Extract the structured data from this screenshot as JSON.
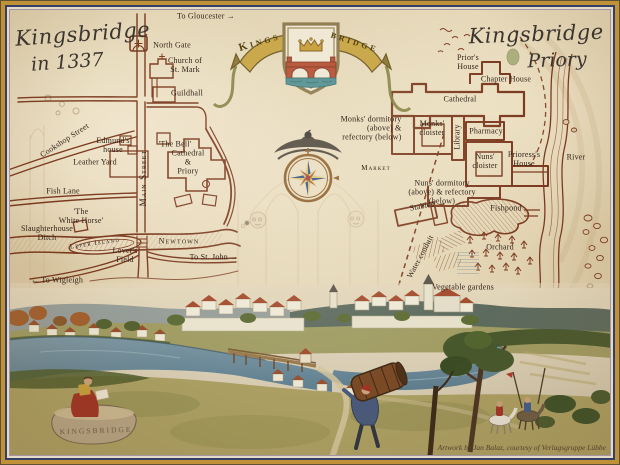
{
  "titles": {
    "town": {
      "line1": "Kingsbridge",
      "line2": "in 1337"
    },
    "priory": {
      "line1": "Kingsbridge",
      "line2": "Priory"
    }
  },
  "banner": {
    "left": "Kings",
    "right": "bridge"
  },
  "monument": {
    "engraving": "KINGSBRIDGE"
  },
  "credit": "Artwork by Jan Balaz, courtesy of Verlagsgruppe Lübbe",
  "colors": {
    "parchment": "#e3d5b5",
    "map_ink": "#7b3a1f",
    "label_ink": "#33241a",
    "frame_gold": "#c09136",
    "frame_navy": "#333f66",
    "banner_gold": "#c6a23f",
    "river_blue": "#6a8697",
    "shield_red": "#b14a2c",
    "compass_navy": "#2e4a7c"
  },
  "decorations": [
    "coat-of-arms",
    "banner-ribbon",
    "compass-rose",
    "falcon-emblem",
    "wind-face",
    "architectural-sketch",
    "reader-figure",
    "barrel-carrier",
    "riders"
  ],
  "town_labels": [
    {
      "id": "to-gloucester",
      "text": "To Gloucester →",
      "x": 206,
      "y": 17
    },
    {
      "id": "north-gate",
      "text": "North Gate",
      "x": 172,
      "y": 46
    },
    {
      "id": "church-of-st-mark",
      "text": "Church of\nSt. Mark",
      "x": 185,
      "y": 66
    },
    {
      "id": "guildhall",
      "text": "Guildhall",
      "x": 187,
      "y": 94
    },
    {
      "id": "cookshop-street",
      "text": "Cookshop Street",
      "x": 65,
      "y": 141,
      "rot": -33
    },
    {
      "id": "edmunds-house",
      "text": "Edmund's\nhouse",
      "x": 113,
      "y": 146
    },
    {
      "id": "the-bell",
      "text": "'The Bell'",
      "x": 175,
      "y": 145
    },
    {
      "id": "leather-yard",
      "text": "Leather Yard",
      "x": 95,
      "y": 163
    },
    {
      "id": "main-street",
      "text": "Main Street",
      "x": 143,
      "y": 178,
      "rot": -90,
      "cls": "caps",
      "size": 9
    },
    {
      "id": "cathedral-and-priory",
      "text": "Cathedral\n&\nPriory",
      "x": 188,
      "y": 163
    },
    {
      "id": "fish-lane",
      "text": "Fish Lane",
      "x": 63,
      "y": 192
    },
    {
      "id": "the-white-horse",
      "text": "'The\nWhite Horse'",
      "x": 81,
      "y": 217
    },
    {
      "id": "slaughterhouse-ditch",
      "text": "Slaughterhouse\nDitch",
      "x": 47,
      "y": 234
    },
    {
      "id": "leper-island",
      "text": "Leper Island",
      "x": 95,
      "y": 244,
      "rot": -8,
      "cls": "caps",
      "size": 7
    },
    {
      "id": "lovers-field",
      "text": "Lover's\nField",
      "x": 125,
      "y": 256
    },
    {
      "id": "newtown",
      "text": "Newtown",
      "x": 179,
      "y": 242,
      "cls": "caps"
    },
    {
      "id": "to-st-john",
      "text": "To St. John →",
      "x": 214,
      "y": 258
    },
    {
      "id": "to-wigleigh",
      "text": "← To Wigleigh",
      "x": 57,
      "y": 281
    }
  ],
  "priory_labels": [
    {
      "id": "priors-house",
      "text": "Prior's\nHouse",
      "x": 468,
      "y": 63
    },
    {
      "id": "chapter-house",
      "text": "Chapter House",
      "x": 506,
      "y": 80
    },
    {
      "id": "cathedral",
      "text": "Cathedral",
      "x": 460,
      "y": 100
    },
    {
      "id": "monks-dormitory",
      "text": "Monks' dormitory\n(above) &\nrefectory (below)",
      "x": 371,
      "y": 129,
      "align": "right"
    },
    {
      "id": "monks-cloister",
      "text": "Monks'\ncloister",
      "x": 432,
      "y": 129
    },
    {
      "id": "library",
      "text": "Library",
      "x": 458,
      "y": 137,
      "rot": -90
    },
    {
      "id": "pharmacy",
      "text": "Pharmacy",
      "x": 486,
      "y": 132
    },
    {
      "id": "nuns-cloister",
      "text": "Nuns'\ncloister",
      "x": 485,
      "y": 162
    },
    {
      "id": "prioresss-house",
      "text": "Prioress's\nHouse",
      "x": 524,
      "y": 160
    },
    {
      "id": "market",
      "text": "Market",
      "x": 376,
      "y": 169,
      "cls": "caps",
      "size": 7
    },
    {
      "id": "nuns-dormitory",
      "text": "Nuns' dormitory\n(above) & refectory\n(below)",
      "x": 442,
      "y": 193
    },
    {
      "id": "stables",
      "text": "Stables",
      "x": 422,
      "y": 207,
      "rot": -10
    },
    {
      "id": "fishpond",
      "text": "Fishpond",
      "x": 506,
      "y": 209
    },
    {
      "id": "orchard",
      "text": "Orchard",
      "x": 500,
      "y": 248
    },
    {
      "id": "water-conduit",
      "text": "Water conduit",
      "x": 421,
      "y": 257,
      "rot": -62
    },
    {
      "id": "vegetable-gardens",
      "text": "Vegetable gardens",
      "x": 463,
      "y": 288
    },
    {
      "id": "river",
      "text": "River",
      "x": 576,
      "y": 158
    }
  ]
}
